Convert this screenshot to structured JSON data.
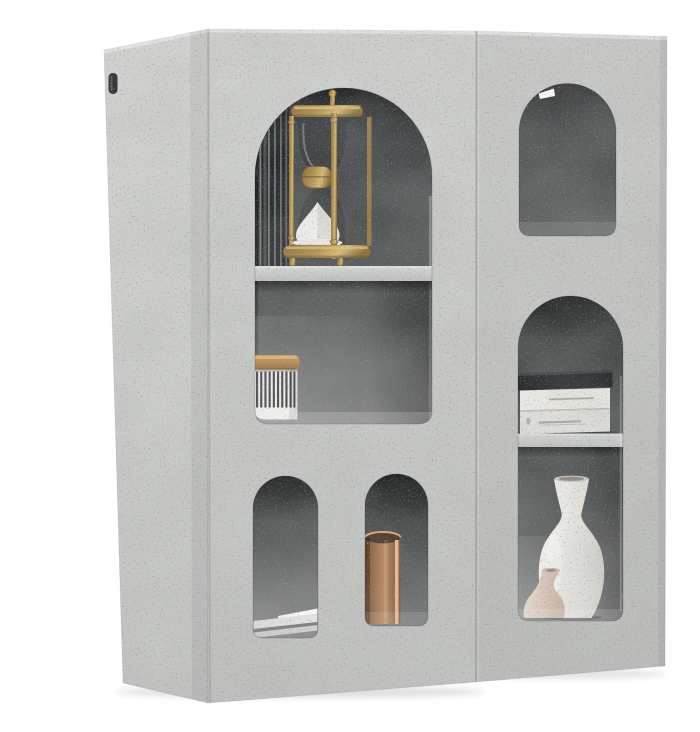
{
  "meta": {
    "alt": "Product photo: concrete-grey wall cabinet set of two units with arched display niches holding a brass hourglass, a striped jar with cork lid, stacked papers, a copper cup, books and two ceramic vases on a white background",
    "background": "#ffffff"
  },
  "colors": {
    "background": "#ffffff",
    "concrete_left_top": "#cfd1ce",
    "concrete_left_bottom": "#c0c2bf",
    "concrete_right_top": "#c9cbc8",
    "concrete_right_bottom": "#bbbdba",
    "side_top": "#d3d5d2",
    "side_bottom": "#c2c4c1",
    "bevel": "#e6e8e5",
    "seam": "#9b9d9a",
    "seam_light": "#e0e2df",
    "niche_big_top": "#45484a",
    "niche_big_bottom": "#636665",
    "niche_bl_top": "#3f4243",
    "niche_bl_bottom": "#8f918f",
    "niche_bm_top": "#393c3d",
    "niche_bm_bottom": "#747776",
    "niche_tr_top": "#4a4d4f",
    "niche_tr_bottom": "#5f6260",
    "niche_tall_top": "#3f4243",
    "niche_tall_bottom": "#6e7170",
    "shelf_top": "#d7d9d6",
    "shelf_bottom": "#bfc1be",
    "brass_dark": "#8a6c38",
    "brass_mid": "#b5924e",
    "brass_light": "#d8bb77",
    "glass_tint": "#2e3134",
    "sand_white": "#f4f3f0",
    "sand_shadow": "#dcdad5",
    "jar_white": "#f4f4f1",
    "jar_stripe": "#3a3c3d",
    "cork_light": "#cfa468",
    "cork_dark": "#9c7440",
    "reflection_stripe": "#a6a8a7",
    "copper_dark": "#7c5335",
    "copper_mid": "#bd8a62",
    "copper_light": "#eec29c",
    "paper_white": "#fafaf9",
    "paper_light": "#e3e3e1",
    "paper_gap": "#7d807f",
    "paper_mid": "#cfd1cf",
    "book_black": "#232527",
    "book_white_1": "#eceae5",
    "book_white_2": "#e3e1dc",
    "book_text": "#a9aaa5",
    "vase_tall_light": "#f2f1ed",
    "vase_tall_dark": "#d3d1cb",
    "vase_small_light": "#eadacd",
    "vase_small_dark": "#c9b2a2",
    "notch_white": "#ffffff",
    "bracket_dark": "#2c2d2e",
    "shadow": "#b9bbb8"
  },
  "objects": {
    "left_cabinet": "concrete-grey cabinet unit with large arched niche and two small arched niches",
    "right_cabinet": "concrete-grey cabinet unit with arched niche and tall display opening",
    "hourglass": "antique brass spindle hourglass with white sand",
    "jar": "white jar with dark vertical stripes and cork lid",
    "papers": "flat stacked papers",
    "copper_cup": "copper cylinder vessel",
    "books": "one black book stacked on two white books",
    "tall_vase": "tall cream ceramic bottle vase",
    "small_vase": "small blush ceramic vase"
  }
}
